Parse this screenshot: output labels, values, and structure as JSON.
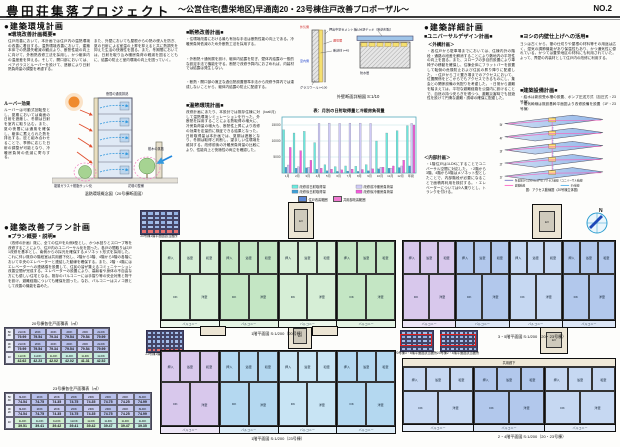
{
  "header": {
    "title": "豊田荘集落プロジェクト",
    "subtitle": "～公営住宅(豊栄地区)早通南20・23号棟住戸改善プロポーザル～",
    "page_no": "NO.2"
  },
  "env": {
    "heading": "●建築環境計画",
    "sub": "■環境改善計画概要■",
    "col1": "住戸改善において、本計画では住戸内の温熱環境の改善に着目する。温熱環境改善において、建築本体での熱損失軽減の観点より、断熱性能の向上に向けて、外断熱改修工法を採用し、かつ躯体内の温度差を抑える。そして、開口部においては、ペアガラスとルーバーを設けて、遮蔽により日射熱負荷量の調整を考慮する。",
    "col2": "また、外壁においても屋根からの熱の侵入を防ぎ、夏の日射による室温の上昇を抑えると共に熱損失を抑えた生活の快適性を図る。また、冬期間においては、日射を取り込み暖房負荷の軽減を図るとともに、結露の防止と室内環境の向上を図っていく。",
    "louver_title": "ルーバー効果",
    "louver_text": "ルーバーは可動式回転型とし、夏期においては南面の日射を遮蔽し、冬期は日射を室内に取り込む。また、夏の夜間には通風を確保し、躯体に蓄えられた熱を排出する。庇と組み合わせることで、季節に応じた日射の調整が可能となり、冷暖房負荷の低減に寄与する。",
    "labels": {
      "glass": "複層ガラス＋樹脂サッシ化",
      "flower": "花壇の整備",
      "tree": "樹木の蒸散",
      "night": "夜間の通風排熱"
    },
    "caption": "温熱環境概念図（20号棟断面図）"
  },
  "ins": {
    "sub": "■断熱改善計画■",
    "bullets": [
      "・住環境改善における最も有効な手法は断熱性能の向上である。冷暖房負荷低減のため外断熱工法を採用する。",
      "・外断熱＋通気層を設け、躯体内結露を防ぎ、壁体内結露の一般的な設定手法で機能を守る。断熱で改修予算内におさめれば、内装材では結露は発生しない。",
      "・断熱・開口部の適正な過伝熱設置基準手法から改修予算内では達成しないことから、躯体内結露の防止に配慮する。"
    ],
    "thermal_sub": "■温熱環境計画■",
    "thermal_text": "改修計画にあたり、本設計では既存住棟に対して温熱環境シミュレーションを行った。外断熱を採用することによる熱取得の増大に、冷房負荷量の増大も、断熱性上昇により改修の効果を定量的に検証できる結果となった。日射取得量は本計画では、夏期は遮蔽となり、冬期は取得と判断し、望ましい住環境を維持する。改修前後の冷暖房負荷量の比較により、性能向上と快適性の両立を確認した。"
  },
  "detail": {
    "l1": "押出中空セメント板（t15）",
    "l2": "通気層",
    "l3": "断熱材 t=45",
    "l4": "グラスウール t=100",
    "l5": "ルーフデッキ（断熱材貼）",
    "l6": "防水層",
    "out": "外気側",
    "in": "室内側",
    "caption": "外壁断面詳細図 S:1/10"
  },
  "chart_data": {
    "type": "bar",
    "title": "表：月別の日射取得量と冷暖房負荷量",
    "ylabel": "(kcal/月)",
    "categories": [
      "1月",
      "2月",
      "3月",
      "4月",
      "5月",
      "6月",
      "7月",
      "8月",
      "9月",
      "10月",
      "11月",
      "12月",
      "年間"
    ],
    "series": [
      {
        "name": "改修前日射取得量",
        "color": "#6ce8dc",
        "values": [
          13500,
          12500,
          13000,
          9500,
          2600,
          2000,
          2200,
          2100,
          2600,
          10000,
          12500,
          13200,
          14800
        ]
      },
      {
        "name": "改修後日射取得量",
        "color": "#3f9fd4",
        "values": [
          1800,
          1500,
          1600,
          1200,
          700,
          500,
          600,
          500,
          700,
          1300,
          1500,
          1700,
          2200
        ]
      },
      {
        "name": "改修前冷暖房負荷量",
        "color": "#cfcaf6",
        "values": [
          2500,
          2000,
          1800,
          15500,
          15600,
          15500,
          15600,
          15600,
          15500,
          1800,
          1500,
          2200,
          15500
        ]
      },
      {
        "name": "改修後冷暖房負荷量",
        "color": "#f25ad8",
        "values": [
          8000,
          7000,
          4000,
          1500,
          1200,
          1000,
          1200,
          1100,
          1300,
          1800,
          2200,
          4000,
          15000
        ]
      }
    ],
    "ylim": [
      0,
      17500
    ],
    "yticks": [
      5000,
      10000,
      15000
    ],
    "grid": true,
    "legend_position": "bottom"
  },
  "det": {
    "heading": "●建築詳細計画",
    "ud_sub": "■ユニバーサルデザイン計画■",
    "gaikou_title": "＜外構計画＞",
    "gaikou_text": "・各住戸から駐車場までにおいては、住棟内外の階段・通路の段差を解消することにより敷地内の平坦性の向上を図る。また、スロープの多目的設置により車椅子の移動を確保し、住棟全体にフラットバーを設置して転倒の危険防止および住民の昇り降りに配慮した。・住戸からゴミ置き場までのアクセスにおいて、位置関係をどこからでもアクセスできるものにし、集会との関係設備の気配りを考慮した。・日常から避難を踏まえては、平坦な避難経路を公園内に設けることで、自然の持つ安らぎを得つつ、避難災害時でも回遊性を設けて円滑な避難・誘導の確保に配慮した。",
    "naibu_title": "＜内部計画＞",
    "naibu_text": "・1階住戸は1LDKにすることでユニバーサル空間に対応した。・2階から3階、4階から5階はメゾネット型としたことで、内部階段が必要になることで面積再利用を検討する。・エレベーターについては9人乗りとし、トランクを付ける。",
    "yoshi_sub": "■ヨシの内壁仕上げへの活用■",
    "yoshi_text": "ヨシは古くから、葦の仕切りや屋根の材料等その用途は広く、湿気の調節機能があり保温性もあり、かつ通気性に優れている。かつては豊栄地区の材料にも利用されていた。よって、界壁の内装材として住戸内の改修に利用する。",
    "setsubi_sub": "■建築設備計画■",
    "setsubi_lines": [
      "・給水は新設受水槽の設置、ポンプ圧送方式（加圧式・23号棟）",
      "・電気幹線は既設基幹平面図より改修設備を設置（1F・23号棟）"
    ]
  },
  "axon": {
    "floors": [
      "5f",
      "4f",
      "3f",
      "2f",
      "1f"
    ],
    "legend": [
      {
        "color": "#8888cc",
        "label": "各乗場からのEVと2戸のアクセス動線（ユニバーサル動線）"
      },
      {
        "color": "#ff77cc",
        "label": "避難動線"
      },
      {
        "color": "#66bbee",
        "label": "EV動線"
      }
    ],
    "caption": "図：アクセス動線図（20号棟立体図）"
  },
  "plan": {
    "heading": "●建築改善プラン計画",
    "sub": "■プラン概要・説明■",
    "text": "（改修の計画）既に、全ての住戸を片側Ⅱ型とし、かつ水回りとスロープ等を改修することにより、住戸内のユニバーサル化を図った。各戸の間取りは2戸1改修を基本とし、南側からの採光を確保するメゾネット形式を採用した。これに伴い既存の階段室は共用廊下化し、2階から3階、4階から5階の各階において中央のエレベーターと連結した動線を確保する。また、2階・4階にはエレベーターへの連絡橋を設置して、住民の皆が集えるコミュニケーション改善空間が完成する。エレベーターの設置により、高齢者や身体の不自由な方にも優しい住宅となる。既存のバルコニーには手摺り等の安全対策と物干を設け、避難経路についても確保を図った。なお、バルコニーはスノコ張として改善の機能を高めた。"
  },
  "tables": [
    {
      "caption": "20号棟各住戸面積表（㎡）",
      "row_labels": [
        "5F\n4F",
        "3F\n2F",
        "1F"
      ],
      "rows": [
        [
          [
            "2LDK",
            "79.99"
          ],
          [
            "2DK",
            "79.54"
          ],
          [
            "2DK",
            "79.34"
          ],
          [
            "2DK",
            "79.54"
          ],
          [
            "2DK",
            "79.54"
          ],
          [
            "2LDK",
            "79.99"
          ]
        ],
        [
          [
            "2LDK",
            "79.99"
          ],
          [
            "2DK",
            "79.54"
          ],
          [
            "2DK",
            "79.34"
          ],
          [
            "2DK",
            "79.54"
          ],
          [
            "2DK",
            "79.54"
          ],
          [
            "2LDK",
            "79.99"
          ]
        ],
        [
          [
            "1LDK",
            "42.62"
          ],
          [
            "1LDK",
            "42.23"
          ],
          [
            "1LDK",
            "42.02"
          ],
          [
            "1LDK",
            "42.02"
          ],
          [
            "1LDK",
            "41.31"
          ],
          [
            "1LDK",
            "42.52"
          ]
        ]
      ]
    },
    {
      "caption": "23号棟各住戸面積表（㎡）",
      "row_labels": [
        "5F\n4F",
        "3F\n2F",
        "1F"
      ],
      "rows": [
        [
          [
            "3LDK",
            "74.54"
          ],
          [
            "2DK",
            "74.75"
          ],
          [
            "2DK",
            "74.35"
          ],
          [
            "2DK",
            "74.75"
          ],
          [
            "2DK",
            "74.35"
          ],
          [
            "2DK",
            "74.75"
          ],
          [
            "2DK",
            "74.25"
          ],
          [
            "3LDK",
            "74.99"
          ]
        ],
        [
          [
            "3LDK",
            "74.54"
          ],
          [
            "2DK",
            "74.75"
          ],
          [
            "2DK",
            "74.35"
          ],
          [
            "2DK",
            "74.75"
          ],
          [
            "2DK",
            "74.35"
          ],
          [
            "2DK",
            "74.75"
          ],
          [
            "2DK",
            "74.25"
          ],
          [
            "3LDK",
            "74.99"
          ]
        ],
        [
          [
            "1LDK",
            "39.51"
          ],
          [
            "1LDK",
            "39.41"
          ],
          [
            "1LDK",
            "39.42"
          ],
          [
            "1LDK",
            "39.41"
          ],
          [
            "1LDK",
            "39.42"
          ],
          [
            "1LDK",
            "39.47"
          ],
          [
            "1LDK",
            "39.47"
          ],
          [
            "1LDK",
            "39.35"
          ]
        ]
      ]
    }
  ],
  "key_grids": [
    {
      "caption": "20号棟1階平面図該当箇所"
    },
    {
      "caption": "23号棟1階平面図該当箇所"
    },
    {
      "caption": "20号棟3・5階平面図該当箇所"
    },
    {
      "caption": "23号棟2・4階平面図該当箇所"
    }
  ],
  "legend_chips": [
    {
      "color": "#5b86d6",
      "label": "住戸改善範囲"
    },
    {
      "color": "#f07ad0",
      "label": "共用部改善範囲"
    }
  ],
  "rooms": {
    "washitsu": "和室",
    "yoshitsu": "洋室",
    "dk": "DK",
    "bath": "浴室",
    "oshiire": "押入",
    "genkan": "玄関",
    "balcony": "バルコニー"
  },
  "floor_plans": {
    "captions": [
      "1階平面図 S:1/200（20号棟）",
      "3・5階平面図 S:1/200（20・23号棟）",
      "1階平面図 S:1/200（23号棟）",
      "2・4階平面図 S:1/200（20・23号棟）"
    ],
    "corridor": "共用廊下",
    "ev": "EV"
  },
  "compass": {
    "label": "N"
  }
}
